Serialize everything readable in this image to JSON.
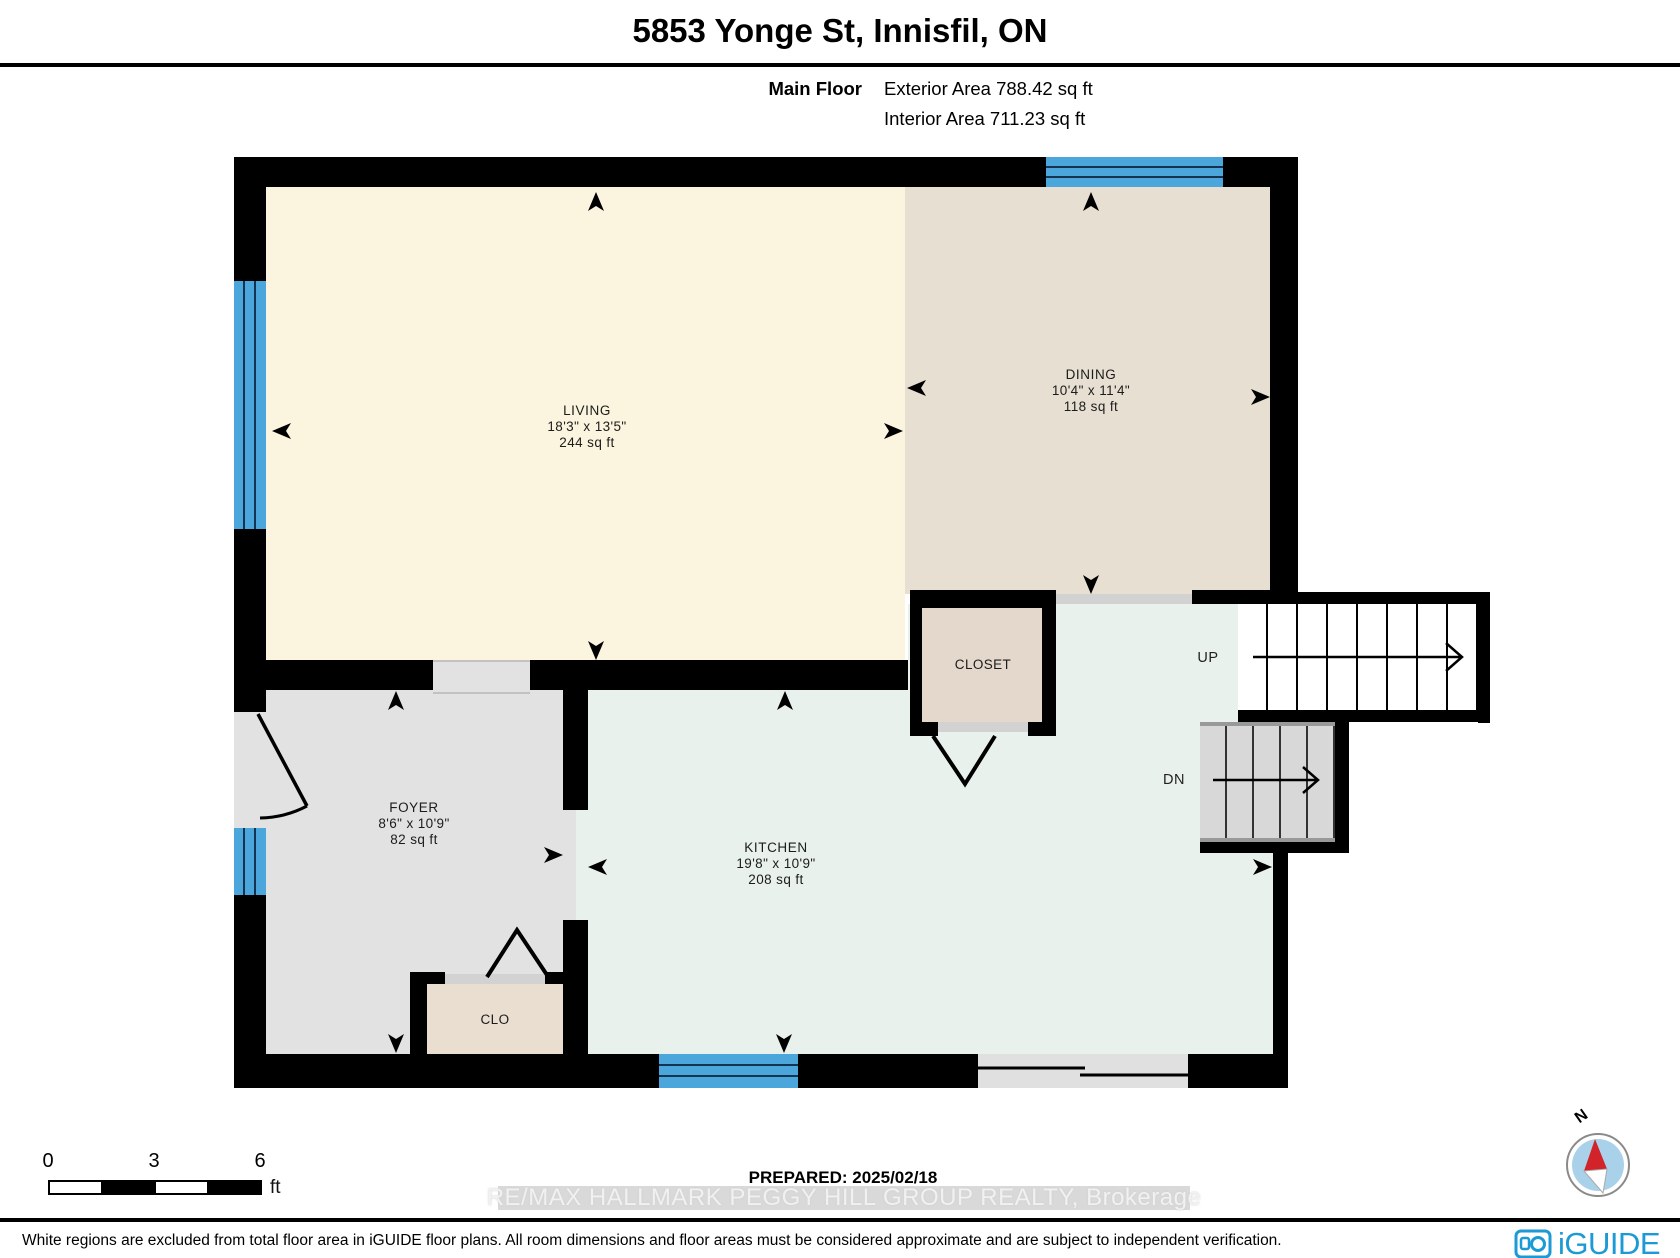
{
  "header": {
    "title": "5853 Yonge St, Innisfil, ON",
    "floor_label": "Main Floor",
    "exterior_area": "Exterior Area 788.42 sq ft",
    "interior_area": "Interior Area 711.23 sq ft"
  },
  "rooms": {
    "living": {
      "name": "LIVING",
      "dims": "18'3\" x 13'5\"",
      "area": "244 sq ft"
    },
    "dining": {
      "name": "DINING",
      "dims": "10'4\" x 11'4\"",
      "area": "118 sq ft"
    },
    "kitchen": {
      "name": "KITCHEN",
      "dims": "19'8\" x 10'9\"",
      "area": "208 sq ft"
    },
    "foyer": {
      "name": "FOYER",
      "dims": "8'6\" x 10'9\"",
      "area": "82 sq ft"
    },
    "closet": {
      "name": "CLOSET"
    },
    "clo": {
      "name": "CLO"
    }
  },
  "stairs": {
    "up_label": "UP",
    "down_label": "DN"
  },
  "scale_bar": {
    "tick_0": "0",
    "tick_3": "3",
    "tick_6": "6",
    "unit": "ft"
  },
  "annotations": {
    "prepared": "PREPARED: 2025/02/18",
    "watermark": "RE/MAX HALLMARK PEGGY HILL GROUP REALTY, Brokerage",
    "disclaimer": "White regions are excluded from total floor area in iGUIDE floor plans. All room dimensions and floor areas must be considered approximate and are subject to independent verification."
  },
  "compass": {
    "north_label": "N"
  },
  "branding": {
    "logo_text": "iGUIDE"
  },
  "colors": {
    "wall": "#000000",
    "living_floor": "#FBF4DE",
    "dining_floor": "#E7DFD2",
    "kitchen_floor": "#E8F1EB",
    "foyer_floor": "#E2E2E2",
    "closet_floor": "#E3D8CB",
    "clo_floor": "#E9DECF",
    "window_blue": "#4BA7DB",
    "logo_blue": "#1C9AD6",
    "compass_red": "#D2232A"
  }
}
